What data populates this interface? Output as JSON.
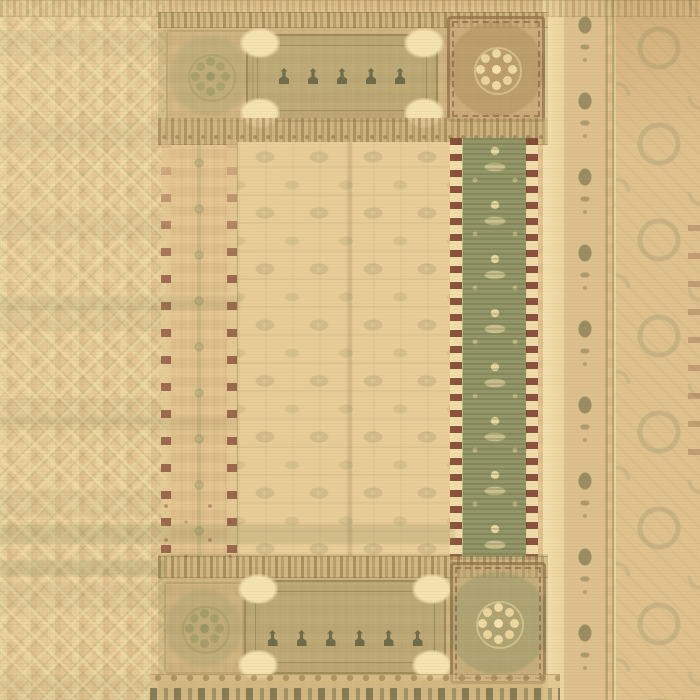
{
  "image": {
    "type": "photograph",
    "subject": "Overhead view of a faded antique oriental area rug",
    "alt": "Worn handwoven rug in tan and cream with a central faded field, sage-green floral border band, maroon reel guard stripes, panel cartouches with tulip motifs, and floral medallions"
  },
  "palette": {
    "base_tan": "#e2c28e",
    "tan_light": "#eed6a2",
    "cream": "#f4e2af",
    "olive": "#9a9a6c",
    "olive_deep": "#6f714a",
    "sage": "#949768",
    "brown": "#a5875a",
    "brown_deep": "#7d5f3c",
    "maroon": "#7c3e2e",
    "ink": "#50543a",
    "rose_brown": "#b18a63"
  },
  "regions": {
    "left_field": "diamond lattice striped field",
    "top_band": "panel band with cartouche and floral medallions",
    "central_field": "faded all-over palmette field",
    "left_guard": "guard band with maroon reel edges and rosette chain",
    "green_guard": "sage green border band with cream floral motifs",
    "right_margin": "outer arabesque border with motif stamp column",
    "bottom_band": "panel band with cartouche, tulip motifs and scallop edge"
  }
}
